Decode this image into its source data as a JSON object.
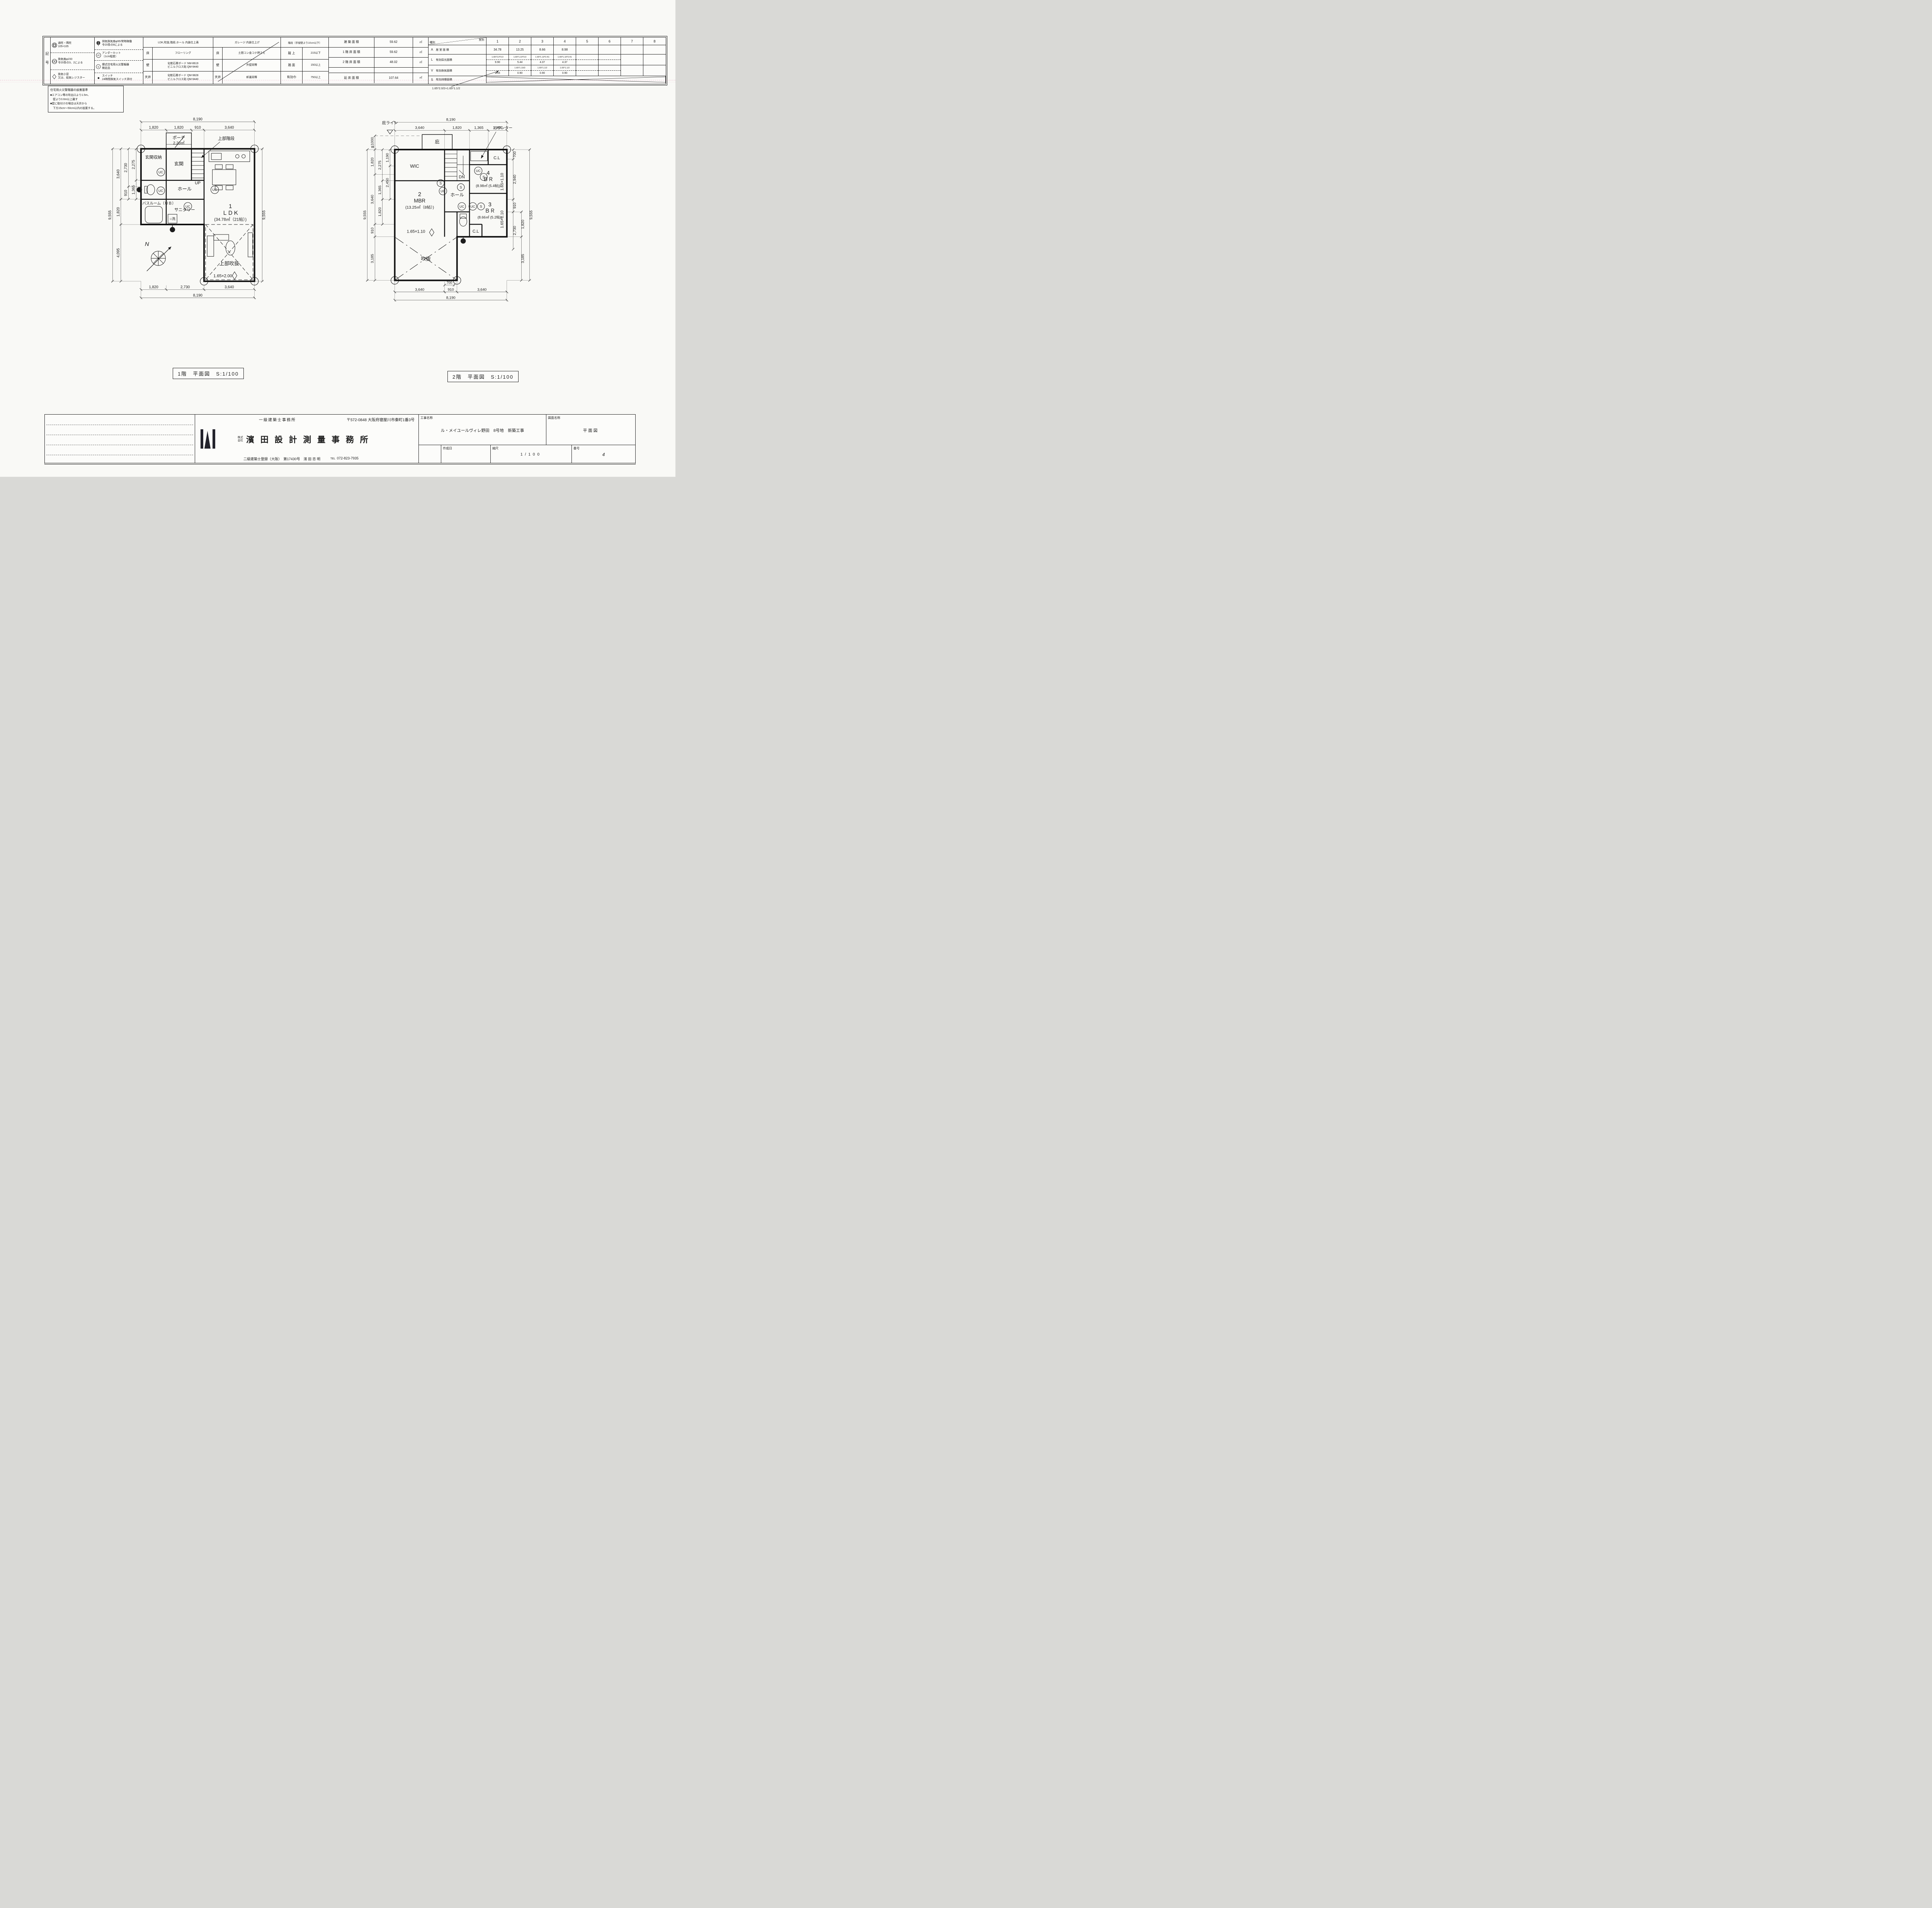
{
  "legend": {
    "title": "記号",
    "uc": "UC",
    "s": "S",
    "col_a": [
      {
        "lines": [
          "通柱・隅柱",
          "105×105"
        ]
      },
      {
        "lines": [
          "換気扇φ150",
          "令20条の3、2による"
        ]
      },
      {
        "lines": [
          "換気小窓",
          "又は、給気レジスター"
        ]
      }
    ],
    "col_b": [
      {
        "lines": [
          "排気換気扇φ95/常時稼働",
          "令20条の8による"
        ]
      },
      {
        "lines": [
          "アンダーカット",
          "（1cm程度）"
        ]
      },
      {
        "lines": [
          "煙式住宅用火災警報器",
          "検定品"
        ]
      },
      {
        "lines": [
          "スイッチ",
          "24時間換気スイッチ添付"
        ]
      }
    ]
  },
  "finish_ldk": {
    "title": "LDK,吹抜,階段,ホール 内装仕上表",
    "rows": [
      {
        "label": "床",
        "value1": "フローリング",
        "value2": ""
      },
      {
        "label": "壁",
        "value1": "化粧石膏ボード NM-8619",
        "value2": "ビニルクロス貼 QM-9440"
      },
      {
        "label": "天井",
        "value1": "化粧石膏ボード QM-9828",
        "value2": "ビニルクロス貼 QM-9440"
      }
    ]
  },
  "finish_garage": {
    "title": "ガレージ 内装仕上げ",
    "rows": [
      {
        "label": "床",
        "value1": "土間コン金コテ押さえ"
      },
      {
        "label": "壁",
        "value1": "外壁同等"
      },
      {
        "label": "天井",
        "value1": "軒裏同等"
      }
    ]
  },
  "stairs_table": {
    "title": "階段（手摺壁より10cm以下）",
    "rows": [
      {
        "label": "蹴 上",
        "value": "215以下"
      },
      {
        "label": "踏 面",
        "value": "150以上"
      },
      {
        "label": "有効巾",
        "value": "750以上"
      }
    ]
  },
  "areas": {
    "rows": [
      {
        "label": "建 築 面 積",
        "value": "59.62",
        "unit": "㎡"
      },
      {
        "label": "1 階 床 面 積",
        "value": "59.62",
        "unit": "㎡"
      },
      {
        "label": "2 階 床 面 積",
        "value": "48.02",
        "unit": "㎡"
      },
      {
        "label": "延 床 面 積",
        "value": "107.64",
        "unit": "㎡"
      }
    ]
  },
  "room_schedule": {
    "kind_label": "種別",
    "room_label": "室別",
    "cols": [
      "1",
      "2",
      "3",
      "4",
      "5",
      "6",
      "7",
      "8"
    ],
    "row_a": {
      "code": "A",
      "label": "居 室 面 積",
      "values": [
        "34.78",
        "13.25",
        "8.66",
        "8.98",
        "",
        "",
        "",
        ""
      ]
    },
    "row_l": {
      "code": "L",
      "label": "有効採光面積",
      "formulas": [
        "1.65*2.0*3.0",
        "1.65*1.10*3.0",
        "1.65*1.10*2.41",
        "1.65*1.10*2.41",
        "",
        "",
        "",
        ""
      ],
      "results": [
        "9.90",
        "5.44",
        "4.37",
        "4.37",
        "",
        "",
        "",
        ""
      ]
    },
    "row_v": {
      "code": "V",
      "label": "有効換気面積",
      "formulas": [
        "",
        "1.65*1.10/2",
        "1.65*1.1/2",
        "1.65*1.1/2",
        "",
        "",
        "",
        ""
      ],
      "results": [
        "2.55",
        "0.90",
        "0.90",
        "0.90",
        "",
        "",
        "",
        ""
      ]
    },
    "row_s": {
      "code": "S",
      "label": "有効排煙面積"
    },
    "annotation": "1.65*2.0/2+1.65*1.1/2"
  },
  "alarm_note": {
    "title": "住宅用火災警報器の設置基準",
    "lines": [
      "■エアコン等の吹出口より1.5m、",
      "　壁より0.6m以上離す",
      "■壁に取付けの場合は天井から",
      "　下方15cm〜50cm以内の設置する。"
    ]
  },
  "plan1": {
    "caption": "1階　平面図　S:1/100",
    "symbols": {
      "uc": "UC",
      "s": "S"
    },
    "rooms": {
      "porch": "ポーチ",
      "porch_area": "2.20㎡",
      "upper_stair": "上部階段",
      "entry": "玄関",
      "entry_storage": "玄関収納",
      "hall": "ホール",
      "up": "UP",
      "sanitary": "サニタリー",
      "bath": "バスルーム（ＵＢ）",
      "wash": "○洗",
      "ldk_no": "1",
      "ldk": "ＬＤＫ",
      "ldk_area": "(34.78㎡（21帖）)",
      "void": "上部吹抜",
      "void_window": "1.65×2.00",
      "north": "N"
    },
    "dims": {
      "top_total": "8,190",
      "top": [
        "1,820",
        "1,820",
        "910",
        "3,640"
      ],
      "left_total": "9,555",
      "left1": [
        "3,640",
        "1,820",
        "4,095"
      ],
      "left2": [
        "2,730",
        "910"
      ],
      "left3": [
        "2,275",
        "1,365"
      ],
      "right_total": "9,555",
      "bottom": [
        "1,820",
        "2,730",
        "3,640"
      ],
      "bottom_total": "8,190"
    }
  },
  "plan2": {
    "caption": "2階　平面図　S:1/100",
    "symbols": {
      "uc": "UC",
      "s": "S"
    },
    "rooms": {
      "eave_line": "庇ライン",
      "eave": "庇",
      "counter": "カウンター",
      "cl_top": "C.L",
      "wic": "WIC",
      "dn": "DN",
      "hall": "ホール",
      "mbr_no": "2",
      "mbr": "MBR",
      "mbr_area": "(13.25㎡（8帖）)",
      "mbr_window": "1.65×1.10",
      "br4_no": "4",
      "br4": "ＢＲ",
      "br4_area": "(8.98㎡ (5.4帖))",
      "br4_window": "1.65×1.10",
      "br3_no": "3",
      "br3": "ＢＲ",
      "br3_area": "(8.66㎡ (5.2帖))",
      "br3_window": "1.65×1.10",
      "cl_mid": "C.L",
      "void": "吹抜"
    },
    "dims": {
      "top_total": "8,190",
      "top": [
        "3,640",
        "1,820",
        "1,365",
        "1,365"
      ],
      "left_total": "9,555",
      "left1": [
        "≦1000",
        "1,820",
        "3,640",
        "910",
        "3,185"
      ],
      "left2": [
        "2,275",
        "1,365",
        "1,820"
      ],
      "left3": [
        "1,190",
        "2,450"
      ],
      "right1": [
        "700",
        "2,940",
        "910",
        "2,730"
      ],
      "right2": [
        "1,820",
        "3,185"
      ],
      "right_total": "9,555",
      "bottom_small": "700",
      "bottom": [
        "3,640",
        "910",
        "3,640"
      ],
      "bottom_total": "8,190"
    }
  },
  "title_block": {
    "office_type": "一級建築士事務所",
    "address": "〒572-0848 大阪府寝屋川市秦町1番3号",
    "kaisha1": "株式",
    "kaisha2": "会社",
    "company": "濱 田 設 計 測 量 事 務 所",
    "registration": "二級建築士登録（大阪）　第17430号　濱 田 忠 明",
    "tel_label": "TEL",
    "tel": "072-823-7935",
    "project_label": "工事名称",
    "project": "ル・メイユールヴィレ野田　8号地　新築工事",
    "drawing_label": "図面名称",
    "drawing": "平面図",
    "created_label": "作成日",
    "scale_label": "縮尺",
    "scale": "1/100",
    "number_label": "番号",
    "number": "4"
  }
}
